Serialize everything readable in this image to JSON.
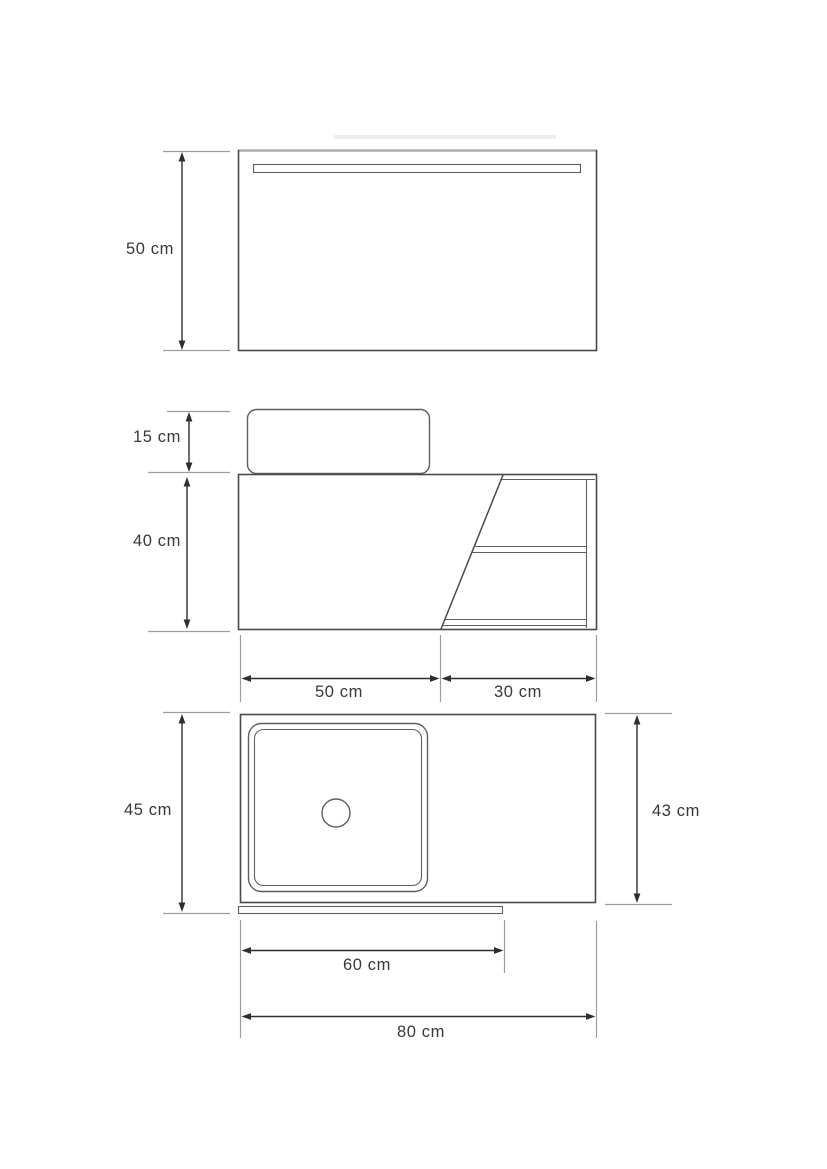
{
  "drawing": {
    "kind": "bathroom vanity technical dimension drawing",
    "views": {
      "mirror_front": "mirror front view",
      "vanity_front": "vanity front view",
      "vanity_top": "vanity top view"
    },
    "dimensions": {
      "mirror_height": "50 cm",
      "basin_height": "15 cm",
      "cabinet_height": "40 cm",
      "cabinet_width": "50 cm",
      "shelf_width": "30 cm",
      "top_depth_left": "45 cm",
      "top_depth_right": "43 cm",
      "basin_section_width": "60 cm",
      "total_width": "80 cm"
    },
    "colors": {
      "line": "#4a4a4a",
      "line2": "#5f5f5f",
      "dim_line": "#2e2e2e",
      "extension_line": "#9d9d9d",
      "light_edge": "#b8b8bc",
      "text": "#383838",
      "background": "#ffffff"
    }
  }
}
